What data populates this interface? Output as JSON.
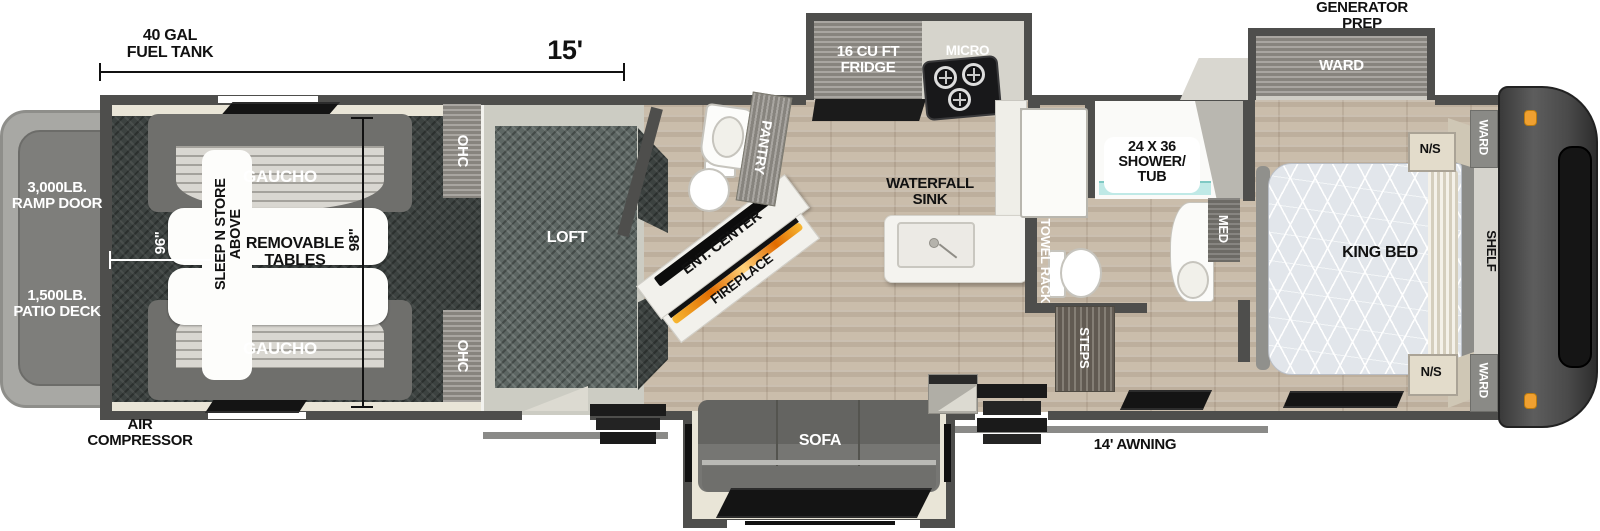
{
  "dimensions": {
    "fuel_tank_l1": "40 GAL",
    "fuel_tank_l2": "FUEL TANK",
    "length": "15'",
    "garage_width": "96\"",
    "garage_depth": "98\"",
    "awning": "14' AWNING"
  },
  "exterior": {
    "generator_l1": "GENERATOR",
    "generator_l2": "PREP",
    "ramp_l1": "3,000LB.",
    "ramp_l2": "RAMP DOOR",
    "patio_l1": "1,500LB.",
    "patio_l2": "PATIO DECK",
    "air_l1": "AIR",
    "air_l2": "COMPRESSOR"
  },
  "garage": {
    "gaucho": "GAUCHO",
    "tables_l1": "REMOVABLE",
    "tables_l2": "TABLES",
    "sleep_l1": "SLEEP N STORE",
    "sleep_l2": "ABOVE",
    "ohc": "OHC",
    "loft": "LOFT"
  },
  "living": {
    "ent_center": "ENT. CENTER",
    "fireplace": "FIREPLACE",
    "pantry": "PANTRY",
    "sofa": "SOFA"
  },
  "kitchen": {
    "fridge_l1": "16 CU FT",
    "fridge_l2": "FRIDGE",
    "micro": "MICRO",
    "sink_l1": "WATERFALL",
    "sink_l2": "SINK"
  },
  "bathroom": {
    "shower_l1": "24 X 36",
    "shower_l2": "SHOWER/",
    "shower_l3": "TUB",
    "towel_rack": "TOWEL RACK",
    "med": "MED",
    "steps": "STEPS"
  },
  "bedroom": {
    "king_bed": "KING BED",
    "ns": "N/S",
    "ward": "WARD",
    "ward_slide": "WARD",
    "shelf": "SHELF"
  },
  "colors": {
    "wall": "#4e4e4c",
    "accent_orange": "#f0a030",
    "shower_glass": "#bfe9e6"
  }
}
